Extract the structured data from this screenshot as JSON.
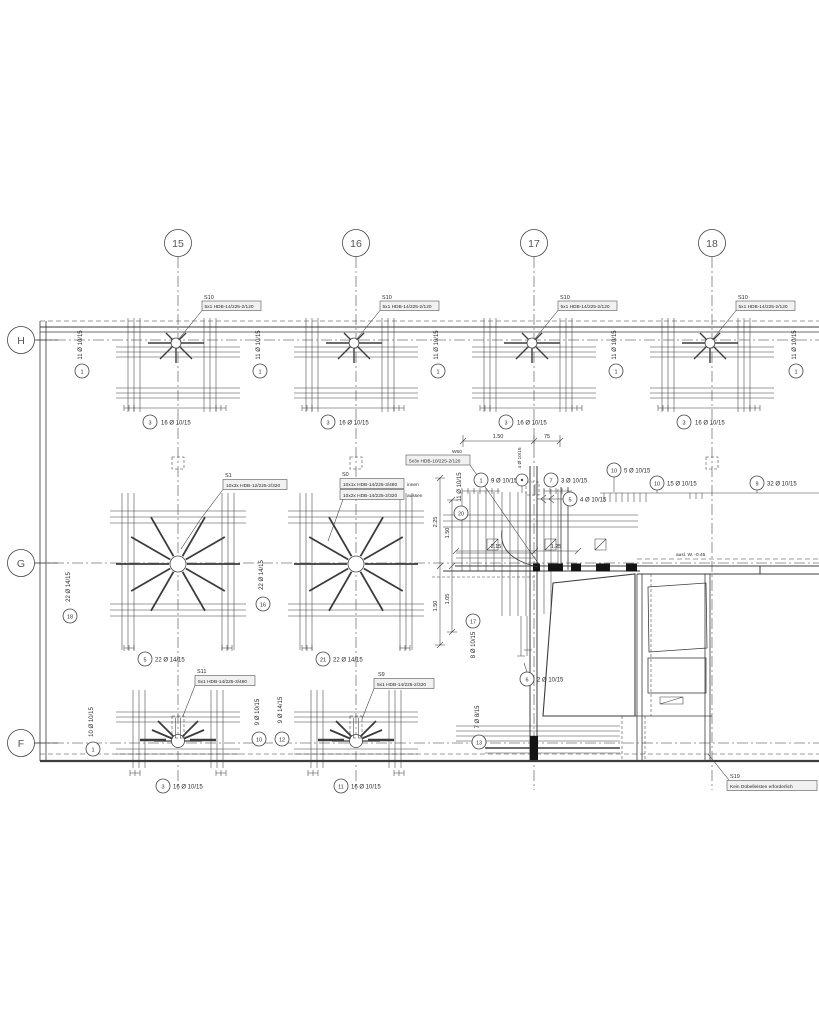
{
  "grid": {
    "columns": [
      "15",
      "16",
      "17",
      "18"
    ],
    "rows": [
      "H",
      "G",
      "F"
    ]
  },
  "shear_rails": {
    "s10": {
      "id": "S10",
      "spec": "5x1 HDB-14/225-2/120"
    },
    "s1": {
      "id": "S1",
      "spec": "10x3x HDB-12/225-2/320"
    },
    "s0": {
      "id": "S0",
      "inner_spec": "10x1x HDB-14/225-3/480",
      "inner_note": "innen",
      "outer_spec": "10x2x HDB-14/225-2/320",
      "outer_note": "aussen"
    },
    "w60": {
      "id": "W60",
      "spec": "5x3x HDB-10/225-2/120"
    },
    "s11": {
      "id": "S11",
      "spec": "5x1 HDB-14/225-3/480"
    },
    "s9": {
      "id": "S9",
      "spec": "5x1 HDB-14/225-2/320"
    },
    "s19": {
      "id": "S19",
      "note": "Kein Dübelleisten erforderlich"
    }
  },
  "rebar_callouts": {
    "h_side": {
      "num": "1",
      "label": "11 Ø 10/15"
    },
    "h_bottom": {
      "num": "3",
      "label": "16 Ø 10/15"
    },
    "g_side_left": {
      "num": "18",
      "label": "22 Ø 14/15"
    },
    "g_side_mid": {
      "num": "16",
      "label": "22 Ø 14/15"
    },
    "g_bottom_15": {
      "num": "5",
      "label": "22 Ø 14/15"
    },
    "g_bottom_16": {
      "num": "21",
      "label": "22 Ø 14/15"
    },
    "pos1": {
      "num": "1",
      "label": "9 Ø 10/15"
    },
    "pos7": {
      "num": "7",
      "label": "3 Ø 10/15"
    },
    "pos5": {
      "num": "5",
      "label": "4 Ø 10/15"
    },
    "pos10a": {
      "num": "10",
      "label": "5 Ø 10/15"
    },
    "pos10b": {
      "num": "10",
      "label": "15 Ø 10/15"
    },
    "pos9": {
      "num": "9",
      "label": "32 Ø 10/15"
    },
    "pos20": {
      "num": "20",
      "label": "11 Ø 10/15"
    },
    "pos17": {
      "num": "17",
      "label": "8 Ø 10/15"
    },
    "pos6": {
      "num": "6",
      "label": "2 Ø 10/15"
    },
    "pos13": {
      "num": "13",
      "label": "7 Ø 8/15"
    },
    "f_side_left": {
      "num": "1",
      "label": "10 Ø 10/15"
    },
    "f10": {
      "num": "10",
      "label": "9 Ø 10/15"
    },
    "f12": {
      "num": "12",
      "label": "9 Ø 14/15"
    },
    "f_bottom_15": {
      "num": "3",
      "label": "16 Ø 10/15"
    },
    "f_bottom_16": {
      "num": "11",
      "label": "16 Ø 10/15"
    },
    "col_tie": {
      "label": "4 Ø 10/15"
    }
  },
  "dimensions": {
    "a": "1.50",
    "b": "75",
    "c": "2.25",
    "d": "1.50",
    "e": "1.50",
    "f": "1.05",
    "g": "2.15",
    "h": "1.25"
  },
  "notes": {
    "level": "ausl. W. -0.45"
  }
}
